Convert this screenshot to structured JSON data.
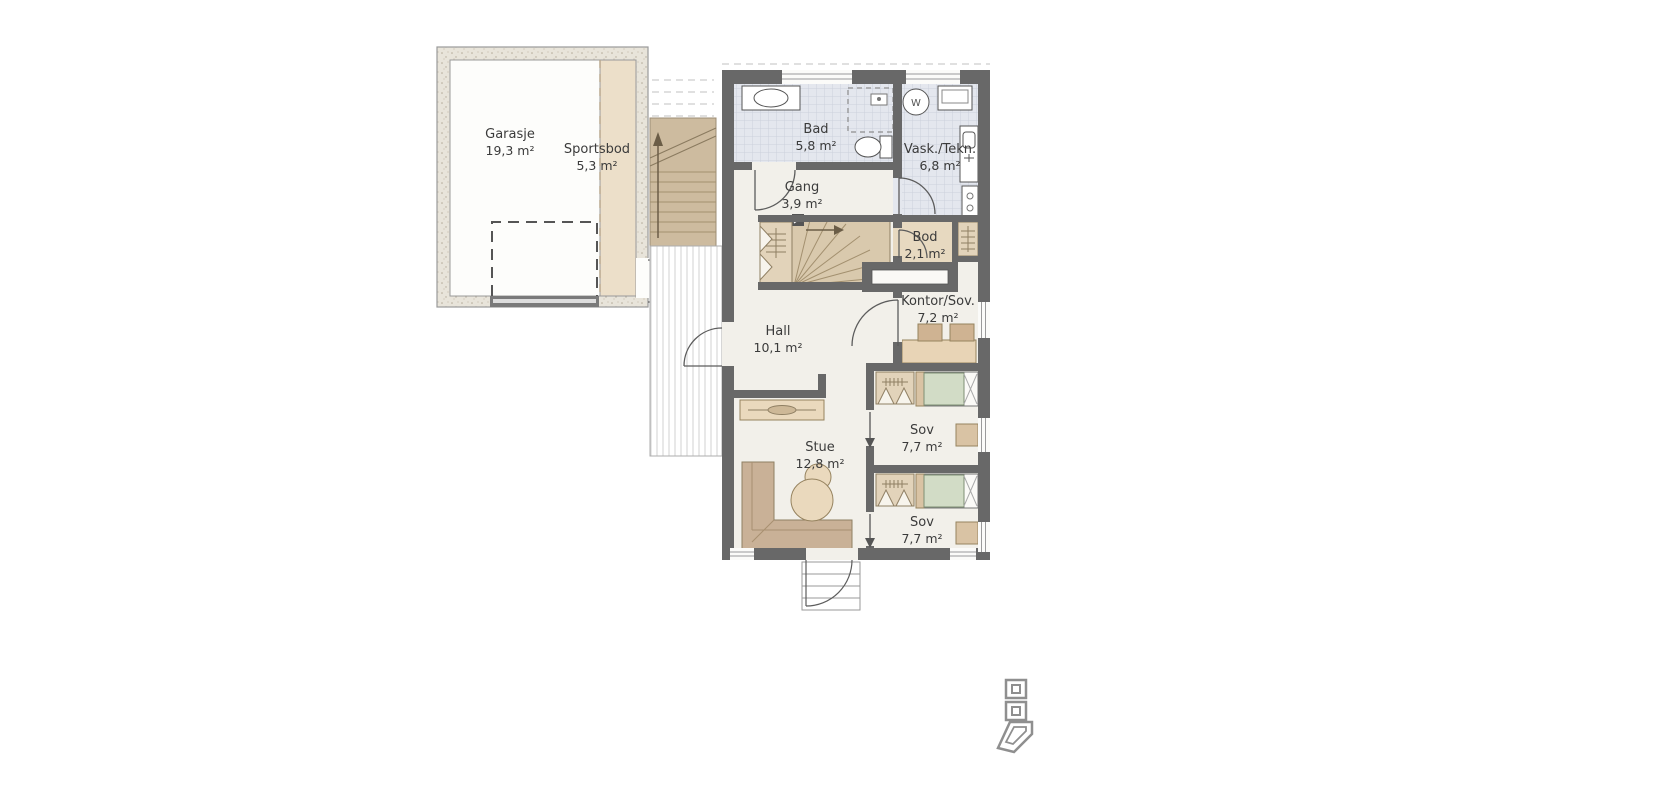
{
  "plan": {
    "type": "floor-plan",
    "language": "Norwegian",
    "rooms": [
      {
        "id": "garasje",
        "name": "Garasje",
        "area": "19,3 m²"
      },
      {
        "id": "sportsbod",
        "name": "Sportsbod",
        "area": "5,3 m²"
      },
      {
        "id": "bad",
        "name": "Bad",
        "area": "5,8 m²"
      },
      {
        "id": "vask-tekn",
        "name": "Vask./Tekn.",
        "area": "6,8 m²"
      },
      {
        "id": "gang",
        "name": "Gang",
        "area": "3,9 m²"
      },
      {
        "id": "bod",
        "name": "Bod",
        "area": "2,1 m²"
      },
      {
        "id": "kontor-sov",
        "name": "Kontor/Sov.",
        "area": "7,2 m²"
      },
      {
        "id": "hall",
        "name": "Hall",
        "area": "10,1 m²"
      },
      {
        "id": "stue",
        "name": "Stue",
        "area": "12,8 m²"
      },
      {
        "id": "sov-1",
        "name": "Sov",
        "area": "7,7 m²"
      },
      {
        "id": "sov-2",
        "name": "Sov",
        "area": "7,7 m²"
      }
    ],
    "appliances": {
      "washing_machine": "W"
    },
    "colors": {
      "wall": "#686868",
      "tile_floor": "#e4e7ee",
      "interior_floor": "#f2f0ea",
      "wood_beige": "#d9c9ad",
      "furniture_tan": "#d9c3a4",
      "duvet_sage": "#d2dcc6",
      "deck_stripe": "#d2d2d2",
      "label_text": "#3b3b3b",
      "logo_gray": "#8f8f8f"
    }
  }
}
